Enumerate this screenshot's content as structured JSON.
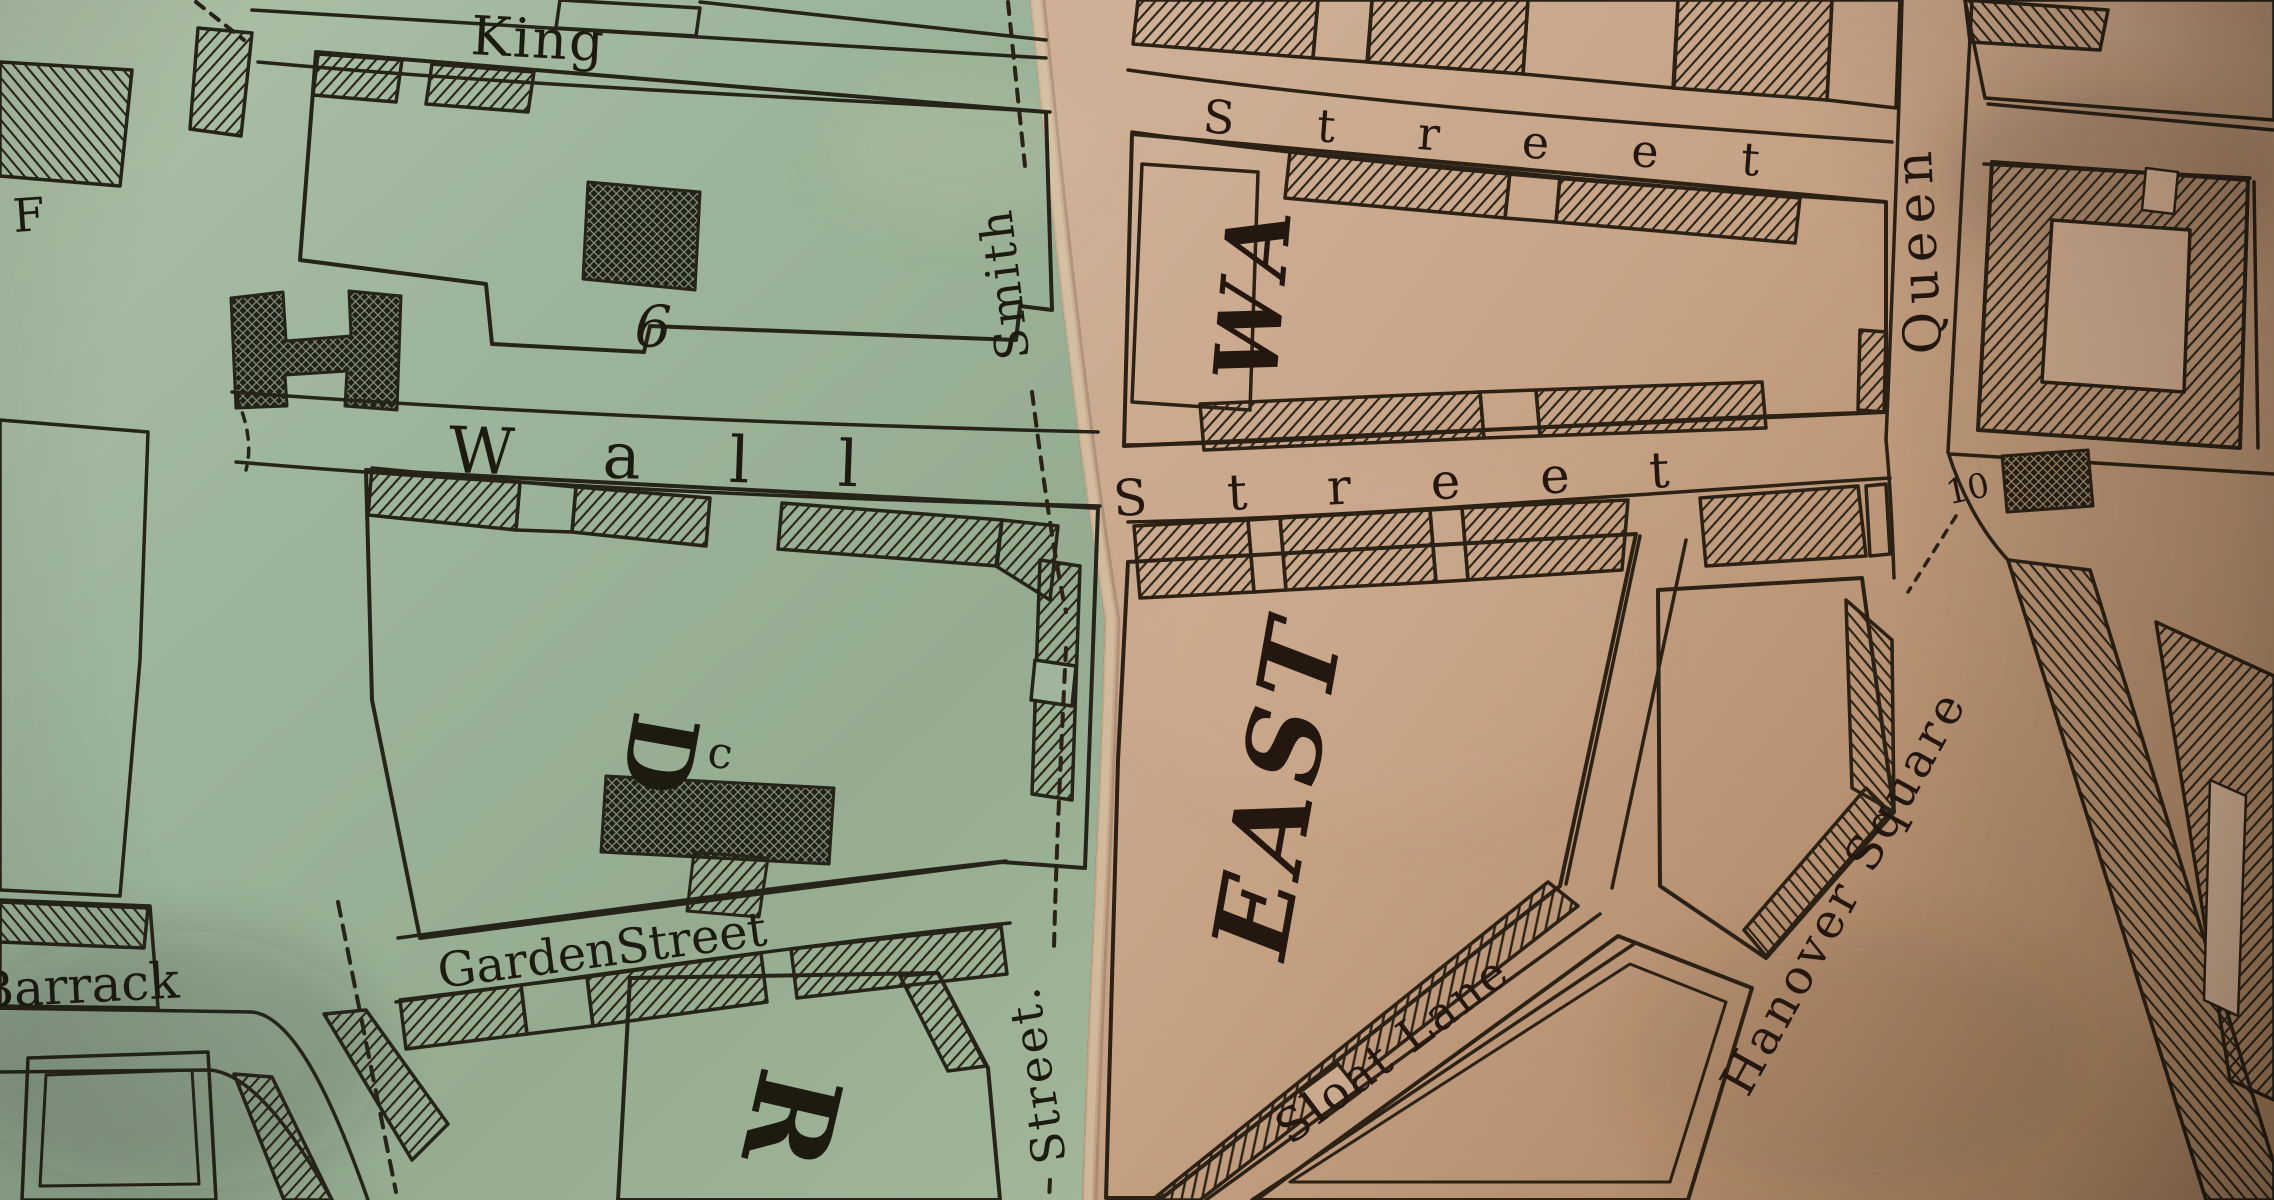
{
  "map": {
    "description": "photograph of an antique engraved city street map, two joined paper sheets",
    "palette": {
      "left_sheet_paper": "#9fb59a",
      "right_sheet_paper": "#c6a183",
      "ink": "#262015"
    },
    "labels": {
      "king_street": "King",
      "f_fragment": "F",
      "block_number_6": "6",
      "wall_street_left": "W a l l",
      "ward_letter_d": "D",
      "lot_letter_c": "c",
      "garden_street": "GardenStreet",
      "barrack_street": "Barrack",
      "ward_letter_r": "R",
      "smith_street": "Smith",
      "smith_street_continued": "Street.",
      "street_top_right": "S t r e e t",
      "ward_east_wa": "WA",
      "wall_street_right": "S t r e e t",
      "queen_street": "Queen",
      "block_number_10": "10",
      "ward_east": "EAST",
      "sloat_lane": "Sloat Lane",
      "hanover_square": "Hanover Square"
    }
  }
}
